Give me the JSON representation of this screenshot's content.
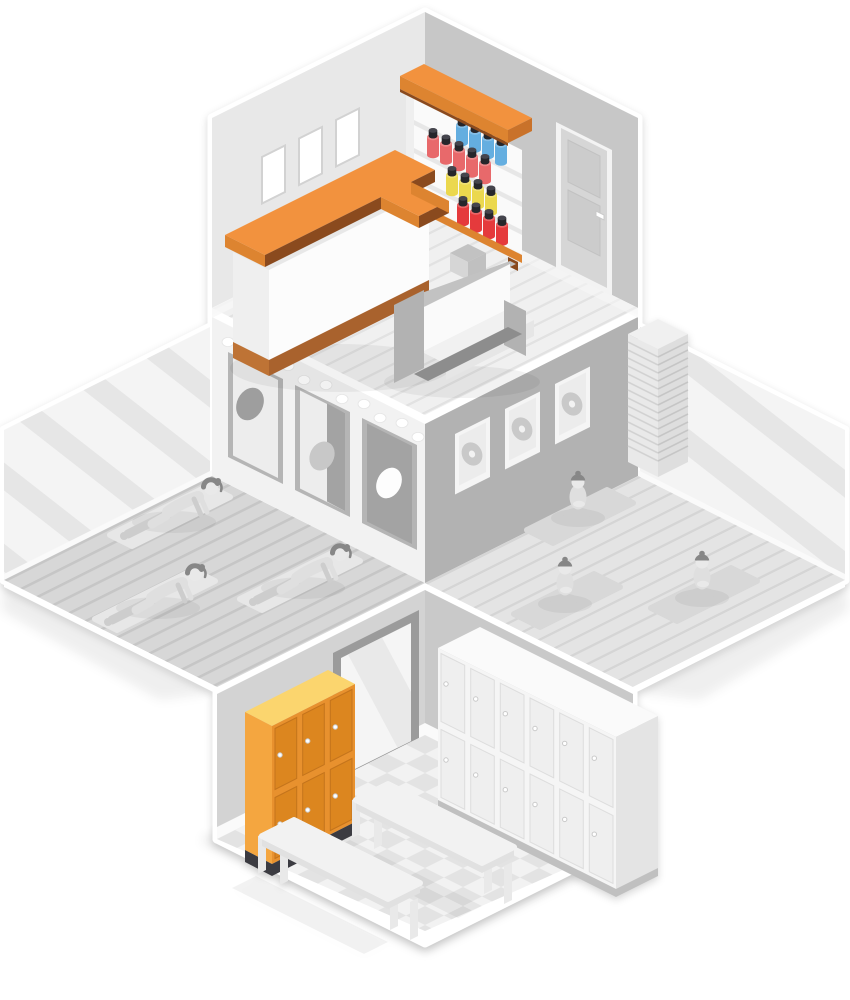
{
  "scene": {
    "title": "Isometric fitness studio cutaway illustration",
    "rooms": [
      {
        "name": "reception",
        "furniture": [
          "reception-desk",
          "supplement-shelf",
          "sofa",
          "paneled-door",
          "wall-pictures"
        ],
        "wall_pictures": 3,
        "shelf_rows": [
          {
            "color_name": "blue",
            "count": 4
          },
          {
            "color_name": "salmon",
            "count": 5
          },
          {
            "color_name": "yellow",
            "count": 4
          },
          {
            "color_name": "red",
            "count": 4
          }
        ]
      },
      {
        "name": "yoga-studio",
        "people": 3,
        "pose": "cat-stretch",
        "mats": 3,
        "posters": 3,
        "vanity_bulbs": 11,
        "features": [
          "mirror-wall",
          "plank-floor"
        ]
      },
      {
        "name": "meditation-room",
        "people": 3,
        "pose": "lotus-meditation",
        "mats": 3,
        "record_frames": 3,
        "features": [
          "mirror-wall",
          "towel-stack",
          "plank-floor"
        ]
      },
      {
        "name": "locker-room",
        "orange_lockers": {
          "columns": 3,
          "rows": 2
        },
        "white_lockers": {
          "columns": 6,
          "rows": 2
        },
        "benches": 2,
        "features": [
          "wall-mirror",
          "checkerboard-floor"
        ]
      }
    ]
  },
  "palette": {
    "pageBg": "#FFFFFF",
    "wallL": "#E8E8E8",
    "wallR": "#C7C7C7",
    "baseboard": "#FAFAFA",
    "recFloor": "#F0F0F0",
    "recStripe": "#E2E2E2",
    "posterWall": "#F2F2F2",
    "recordWall": "#B2B2B2",
    "rimWhite": "#FFFFFF",
    "mirror": "#F4F4F4",
    "mirrorStripe": "#E6E6E6",
    "yogaFloor": "#D7D7D7",
    "yogaStripe": "#C6C6C6",
    "medFloor": "#E4E4E4",
    "medStripe": "#D5D5D5",
    "lockWallL": "#D3D3D3",
    "lockWallR": "#C9C9C9",
    "mirrorFrame": "#9B9B9B",
    "doorMirror": "#F5F5F5",
    "doorMirrorStripe": "#E9E9E9",
    "tileA": "#F2F2F2",
    "tileB": "#E3E3E3",
    "orangeTop": "#F2923E",
    "orangeBand": "#DD8430",
    "brownEdge": "#8A4A1E",
    "brownBase": "#A9622D",
    "brownBaseSide": "#BE7335",
    "deskWhite": "#FCFCFC",
    "deskSide": "#EFEFEF",
    "shelfWhite": "#FAFAFA",
    "shelfBoard": "#E7E7E7",
    "capRight": "#C9722A",
    "canBlue": "#64AEE0",
    "canSalmon": "#E8696B",
    "canYellow": "#EBD84E",
    "canRed": "#E53A3C",
    "lidDark": "#26262B",
    "lidTop": "#45454D",
    "frameWhite": "#FFFFFF",
    "frameEdge": "#D2D2D2",
    "posterFrame": "#B5B5B5",
    "posterBg": "#EDEDED",
    "posterDark": "#A3A3A3",
    "posterCircle": "#9E9E9E",
    "recFrame": "#F5F5F5",
    "recMat": "#ECECEC",
    "recordDisc": "#C9C9C9",
    "doorFrame": "#F3F3F3",
    "doorFace": "#D6D6D6",
    "doorPanel": "#CCCCCC",
    "sofaGray": "#B2B2B2",
    "sofaGrayLight": "#C2C2C2",
    "sofaWhite": "#FAFAFA",
    "sofaSeat": "#F1F1F1",
    "sofaBase": "#8D8D8D",
    "towelTop": "#F0F0F0",
    "towelL": "#E9E9E9",
    "towelR": "#DEDEDE",
    "towelLineL": "#D2D2D2",
    "towelLineR": "#C6C6C6",
    "lockOrFrame": "#E8912E",
    "lockOrDoor": "#DC861F",
    "lockOrLine": "#C4741C",
    "lockOrSide": "#F4A640",
    "lockOrTop": "#FBD56E",
    "lockBase": "#3B3B41",
    "lockWhFrame": "#F5F5F5",
    "lockWhDoor": "#EFEFEF",
    "lockWhLine": "#DDDDDD",
    "lockWhSide": "#E4E4E4",
    "lockWhTop": "#FAFAFA",
    "lockWhBase": "#C0C0C0",
    "benchTop": "#F2F2F2",
    "benchSide": "#E1E1E1",
    "benchLeg": "#E9E9E9",
    "matYoga": "#E7E7E7",
    "matMed": "#D8D8D8",
    "figBody": "#DFDFDF",
    "figShade": "#CDCDCD",
    "figLight": "#E9E9E9",
    "hair": "#878787",
    "bulb": "#FFFFFF"
  }
}
